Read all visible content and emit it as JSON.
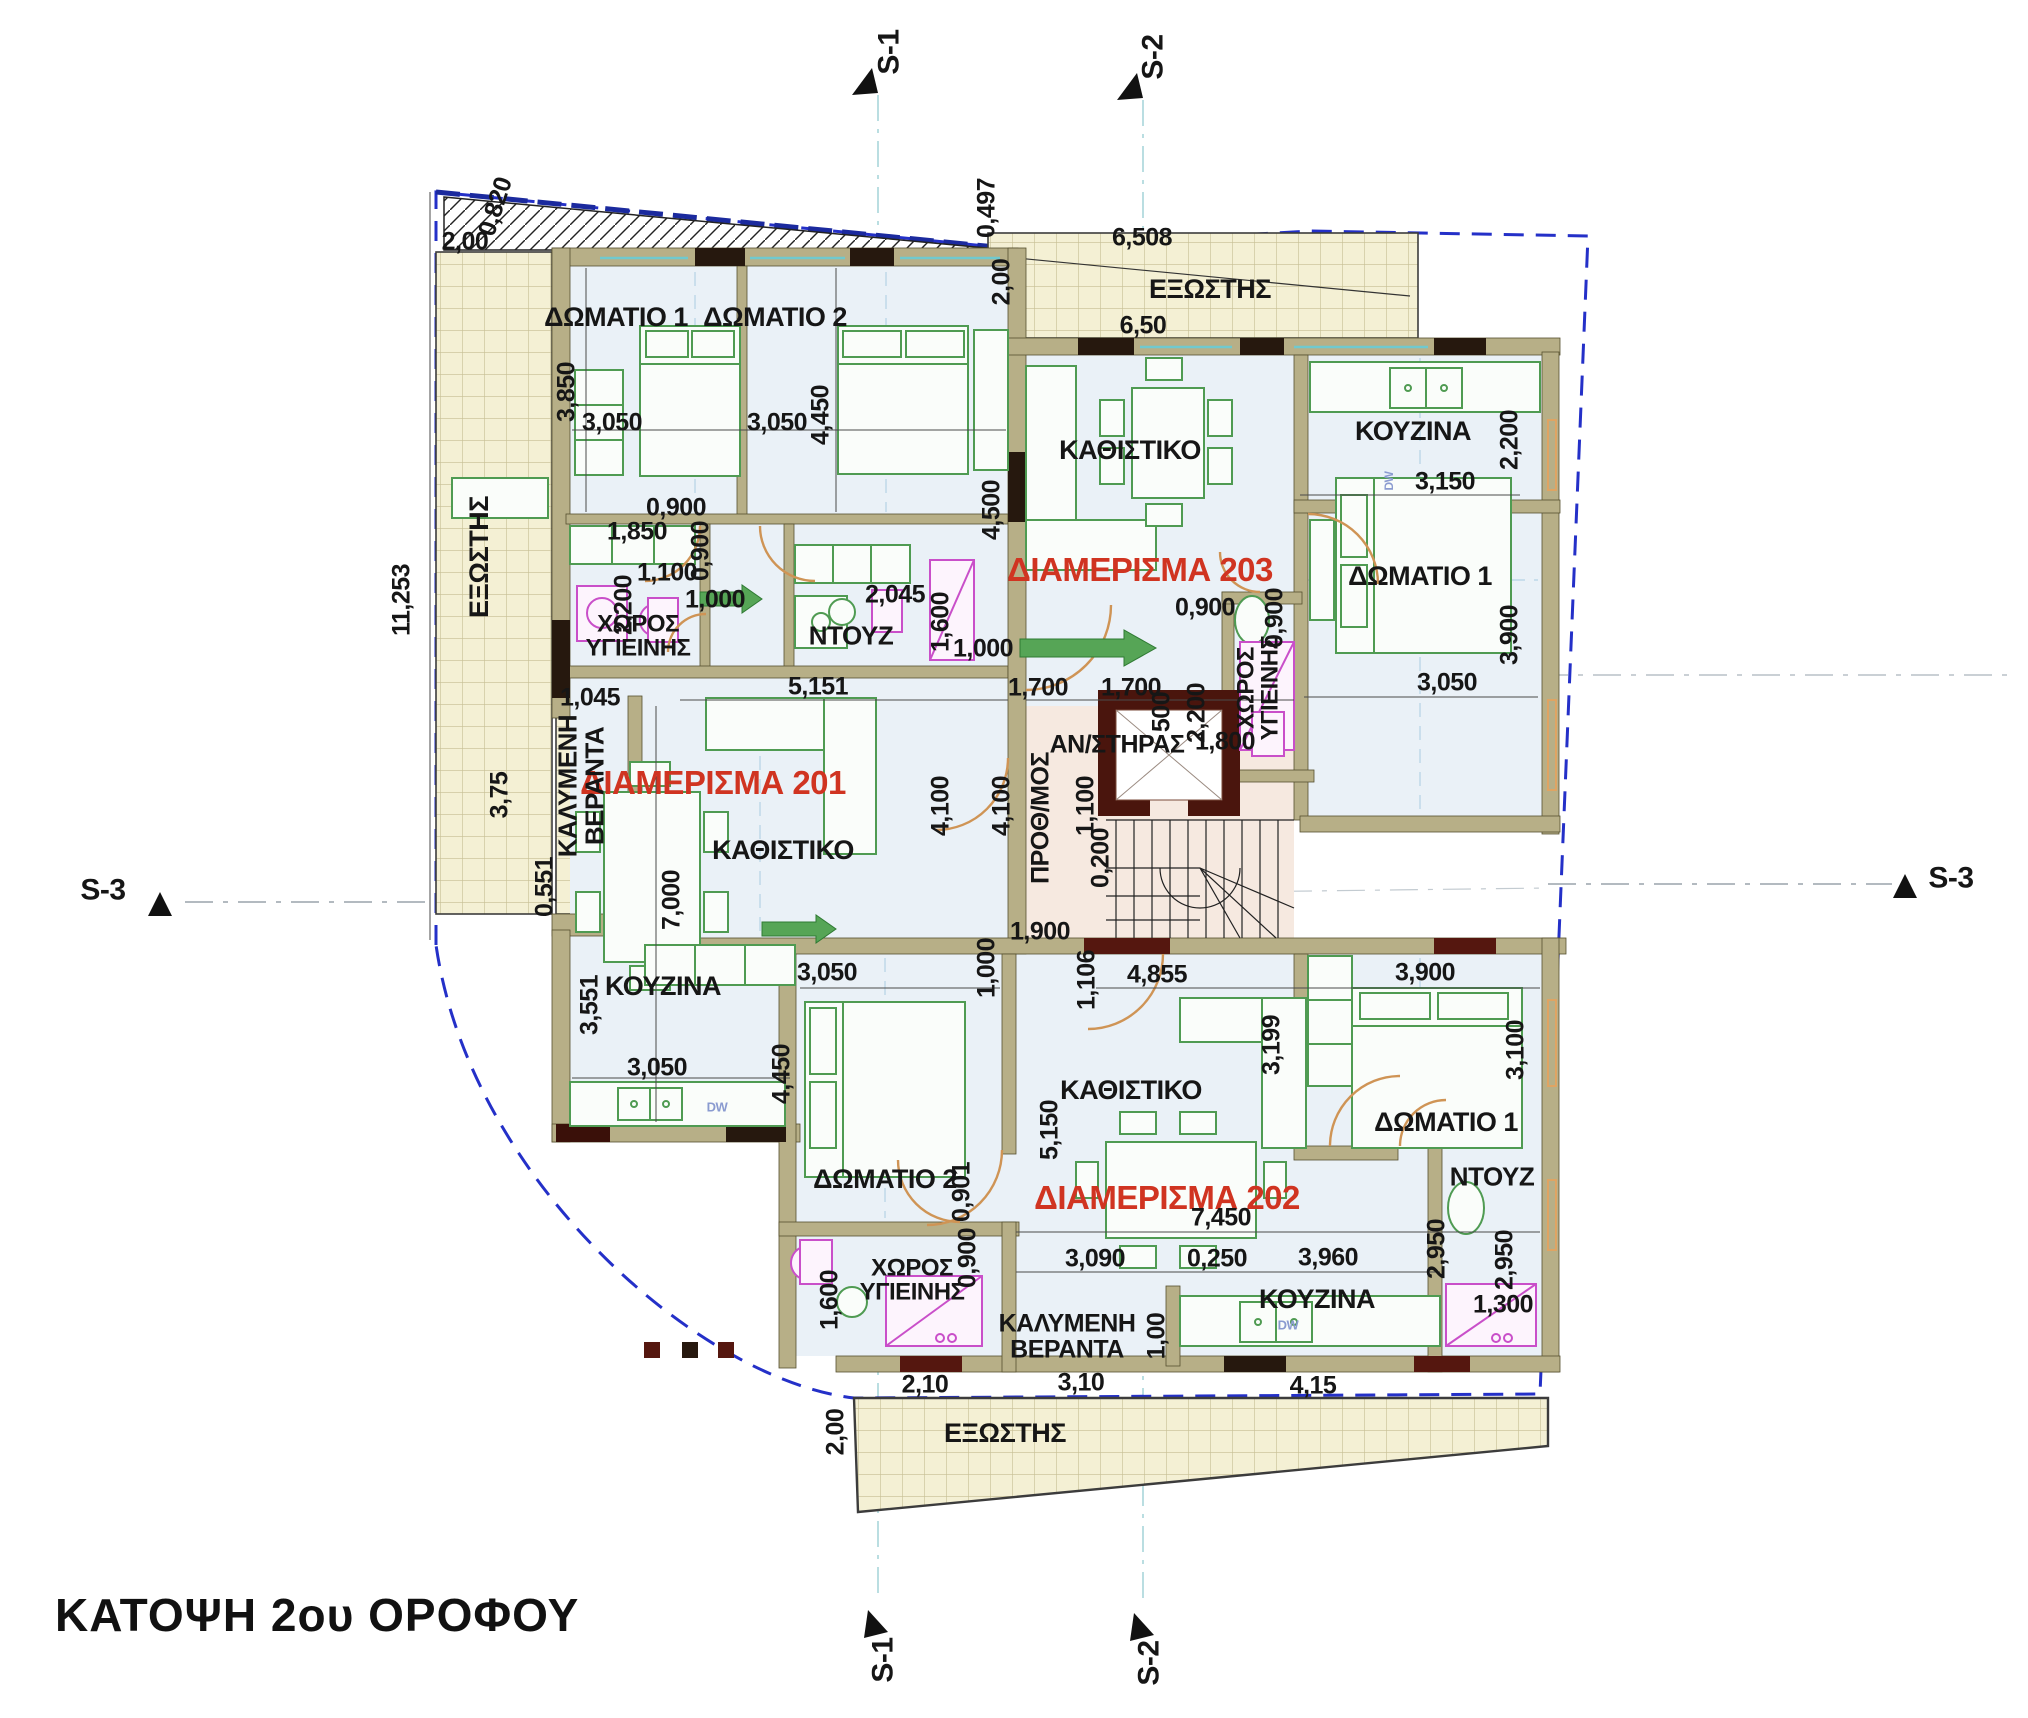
{
  "title": {
    "text": "ΚΑΤΟΨΗ 2ου ΟΡΟΦΟΥ"
  },
  "colors": {
    "apartment_label": "#d03421",
    "dimension_text": "#161616",
    "wall": "#b7af87",
    "room_floor": "#eaf1f7",
    "balcony_floor": "#f4f0d4",
    "stair_hall_floor": "#f6e9e0",
    "boundary_dashed": "#2430c8",
    "furniture_green": "#4f9b52",
    "fixture_magenta": "#c94fc9",
    "door_arc": "#cf9455"
  },
  "apartments": [
    "ΔΙΑΜΕΡΙΣΜΑ 201",
    "ΔΙΑΜΕΡΙΣΜΑ 202",
    "ΔΙΑΜΕΡΙΣΜΑ 203"
  ],
  "labels": [
    {
      "n": "section-marker-s1-top",
      "t": "S-1",
      "x": 890,
      "y": 52,
      "r": -90,
      "s": 30,
      "b": 1
    },
    {
      "n": "section-marker-s2-top",
      "t": "S-2",
      "x": 1154,
      "y": 57,
      "r": -90,
      "s": 30,
      "b": 1
    },
    {
      "n": "section-marker-s3-left",
      "t": "S-3",
      "x": 103,
      "y": 891,
      "r": 0,
      "s": 30,
      "b": 1
    },
    {
      "n": "section-marker-s3-right",
      "t": "S-3",
      "x": 1951,
      "y": 879,
      "r": 0,
      "s": 30,
      "b": 1
    },
    {
      "n": "section-marker-s1-bottom",
      "t": "S-1",
      "x": 884,
      "y": 1660,
      "r": -90,
      "s": 30,
      "b": 1
    },
    {
      "n": "section-marker-s2-bottom",
      "t": "S-2",
      "x": 1150,
      "y": 1663,
      "r": -90,
      "s": 30,
      "b": 1
    },
    {
      "n": "apartment-201-label",
      "t": "ΔΙΑΜΕΡΙΣΜΑ 201",
      "x": 713,
      "y": 783,
      "r": 0,
      "s": 33,
      "b": 1,
      "c": "#d03421"
    },
    {
      "n": "apartment-202-label",
      "t": "ΔΙΑΜΕΡΙΣΜΑ 202",
      "x": 1167,
      "y": 1198,
      "r": 0,
      "s": 33,
      "b": 1,
      "c": "#d03421"
    },
    {
      "n": "apartment-203-label",
      "t": "ΔΙΑΜΕΡΙΣΜΑ 203",
      "x": 1140,
      "y": 570,
      "r": 0,
      "s": 33,
      "b": 1,
      "c": "#d03421"
    },
    {
      "n": "room-201-bedroom1",
      "t": "ΔΩΜΑΤΙΟ 1",
      "x": 616,
      "y": 318,
      "r": 0,
      "s": 27,
      "b": 1
    },
    {
      "n": "room-201-bedroom2",
      "t": "ΔΩΜΑΤΙΟ 2",
      "x": 775,
      "y": 318,
      "r": 0,
      "s": 27,
      "b": 1
    },
    {
      "n": "room-201-bathroom",
      "t": "ΧΩΡΟΣ\nΥΓΙΕΙΝΗΣ",
      "x": 638,
      "y": 637,
      "r": 0,
      "s": 24,
      "b": 1
    },
    {
      "n": "room-201-shower",
      "t": "ΝΤΟΥΖ",
      "x": 851,
      "y": 636,
      "r": 0,
      "s": 26,
      "b": 1
    },
    {
      "n": "room-201-living",
      "t": "ΚΑΘΙΣΤΙΚΟ",
      "x": 783,
      "y": 851,
      "r": 0,
      "s": 27,
      "b": 1
    },
    {
      "n": "room-201-kitchen",
      "t": "ΚΟΥΖΙΝΑ",
      "x": 663,
      "y": 987,
      "r": 0,
      "s": 27,
      "b": 1
    },
    {
      "n": "room-201-covered-veranda",
      "t": "ΚΑΛΥΜΕΝΗ\nΒΕΡΑΝΤΑ",
      "x": 581,
      "y": 786,
      "r": -90,
      "s": 26,
      "b": 1
    },
    {
      "n": "room-balcony-left",
      "t": "ΕΞΩΣΤΗΣ",
      "x": 480,
      "y": 557,
      "r": -90,
      "s": 27,
      "b": 1
    },
    {
      "n": "room-balcony-top",
      "t": "ΕΞΩΣΤΗΣ",
      "x": 1210,
      "y": 290,
      "r": 0,
      "s": 27,
      "b": 1
    },
    {
      "n": "room-203-living",
      "t": "ΚΑΘΙΣΤΙΚΟ",
      "x": 1130,
      "y": 451,
      "r": 0,
      "s": 27,
      "b": 1
    },
    {
      "n": "room-203-kitchen",
      "t": "ΚΟΥΖΙΝΑ",
      "x": 1413,
      "y": 432,
      "r": 0,
      "s": 27,
      "b": 1
    },
    {
      "n": "room-203-bedroom1",
      "t": "ΔΩΜΑΤΙΟ 1",
      "x": 1420,
      "y": 577,
      "r": 0,
      "s": 27,
      "b": 1
    },
    {
      "n": "room-203-bathroom",
      "t": "ΧΩΡΟΣ\nΥΓΙΕΙΝΗΣ",
      "x": 1259,
      "y": 688,
      "r": -90,
      "s": 24,
      "b": 1
    },
    {
      "n": "room-elevator",
      "t": "ΑΝ/ΣΤΗΡΑΣ",
      "x": 1117,
      "y": 745,
      "r": 0,
      "s": 25,
      "b": 1
    },
    {
      "n": "room-entry-hall",
      "t": "ΠΡΟΘ/ΜΟΣ",
      "x": 1041,
      "y": 818,
      "r": -90,
      "s": 25,
      "b": 1
    },
    {
      "n": "room-202-living",
      "t": "ΚΑΘΙΣΤΙΚΟ",
      "x": 1131,
      "y": 1091,
      "r": 0,
      "s": 27,
      "b": 1
    },
    {
      "n": "room-202-bedroom2",
      "t": "ΔΩΜΑΤΙΟ 2",
      "x": 885,
      "y": 1180,
      "r": 0,
      "s": 27,
      "b": 1
    },
    {
      "n": "room-202-bedroom1",
      "t": "ΔΩΜΑΤΙΟ 1",
      "x": 1446,
      "y": 1123,
      "r": 0,
      "s": 27,
      "b": 1
    },
    {
      "n": "room-202-shower",
      "t": "ΝΤΟΥΖ",
      "x": 1492,
      "y": 1177,
      "r": 0,
      "s": 26,
      "b": 1
    },
    {
      "n": "room-202-kitchen",
      "t": "ΚΟΥΖΙΝΑ",
      "x": 1317,
      "y": 1300,
      "r": 0,
      "s": 27,
      "b": 1
    },
    {
      "n": "room-202-bathroom",
      "t": "ΧΩΡΟΣ\nΥΓΙΕΙΝΗΣ",
      "x": 912,
      "y": 1281,
      "r": 0,
      "s": 24,
      "b": 1
    },
    {
      "n": "room-202-covered-veranda",
      "t": "ΚΑΛΥΜΕΝΗ\nΒΕΡΑΝΤΑ",
      "x": 1067,
      "y": 1337,
      "r": 0,
      "s": 25,
      "b": 1
    },
    {
      "n": "room-balcony-bottom",
      "t": "ΕΞΩΣΤΗΣ",
      "x": 1005,
      "y": 1434,
      "r": 0,
      "s": 27,
      "b": 1
    },
    {
      "n": "dim",
      "t": "2,00",
      "x": 465,
      "y": 242,
      "r": 0,
      "s": 25
    },
    {
      "n": "dim",
      "t": "0,820",
      "x": 496,
      "y": 207,
      "r": -72,
      "s": 25
    },
    {
      "n": "dim",
      "t": "0,497",
      "x": 987,
      "y": 208,
      "r": -90,
      "s": 25
    },
    {
      "n": "dim",
      "t": "2,00",
      "x": 1002,
      "y": 282,
      "r": -90,
      "s": 25
    },
    {
      "n": "dim",
      "t": "6,508",
      "x": 1142,
      "y": 238,
      "r": 0,
      "s": 25
    },
    {
      "n": "dim",
      "t": "6,50",
      "x": 1143,
      "y": 326,
      "r": 0,
      "s": 25
    },
    {
      "n": "dim",
      "t": "3,850",
      "x": 567,
      "y": 392,
      "r": -90,
      "s": 25
    },
    {
      "n": "dim",
      "t": "3,050",
      "x": 612,
      "y": 423,
      "r": 0,
      "s": 25
    },
    {
      "n": "dim",
      "t": "3,050",
      "x": 777,
      "y": 423,
      "r": 0,
      "s": 25
    },
    {
      "n": "dim",
      "t": "4,450",
      "x": 821,
      "y": 415,
      "r": -90,
      "s": 25
    },
    {
      "n": "dim",
      "t": "0,900",
      "x": 676,
      "y": 508,
      "r": 0,
      "s": 25
    },
    {
      "n": "dim",
      "t": "0,900",
      "x": 701,
      "y": 551,
      "r": -90,
      "s": 25
    },
    {
      "n": "dim",
      "t": "1,850",
      "x": 637,
      "y": 532,
      "r": 0,
      "s": 25
    },
    {
      "n": "dim",
      "t": "2,200",
      "x": 624,
      "y": 605,
      "r": -90,
      "s": 25
    },
    {
      "n": "dim",
      "t": "1,100",
      "x": 667,
      "y": 573,
      "r": 0,
      "s": 25
    },
    {
      "n": "dim",
      "t": "1,000",
      "x": 715,
      "y": 600,
      "r": 0,
      "s": 25
    },
    {
      "n": "dim",
      "t": "2,045",
      "x": 895,
      "y": 595,
      "r": 0,
      "s": 25
    },
    {
      "n": "dim",
      "t": "1,600",
      "x": 941,
      "y": 622,
      "r": -90,
      "s": 25
    },
    {
      "n": "dim",
      "t": "1,000",
      "x": 983,
      "y": 649,
      "r": 0,
      "s": 25
    },
    {
      "n": "dim",
      "t": "5,151",
      "x": 818,
      "y": 687,
      "r": 0,
      "s": 25
    },
    {
      "n": "dim",
      "t": "11,253",
      "x": 402,
      "y": 600,
      "r": -90,
      "s": 25
    },
    {
      "n": "dim",
      "t": "3,75",
      "x": 500,
      "y": 795,
      "r": -90,
      "s": 25
    },
    {
      "n": "dim",
      "t": "0,551",
      "x": 545,
      "y": 887,
      "r": -90,
      "s": 25
    },
    {
      "n": "dim",
      "t": "1,045",
      "x": 590,
      "y": 698,
      "r": 0,
      "s": 25
    },
    {
      "n": "dim",
      "t": "7,000",
      "x": 672,
      "y": 900,
      "r": -90,
      "s": 25
    },
    {
      "n": "dim",
      "t": "3,551",
      "x": 590,
      "y": 1005,
      "r": -90,
      "s": 25
    },
    {
      "n": "dim",
      "t": "3,050",
      "x": 657,
      "y": 1068,
      "r": 0,
      "s": 25
    },
    {
      "n": "dim",
      "t": "4,100",
      "x": 941,
      "y": 806,
      "r": -90,
      "s": 25
    },
    {
      "n": "dim",
      "t": "4,100",
      "x": 1002,
      "y": 806,
      "r": -90,
      "s": 25
    },
    {
      "n": "dim",
      "t": "1,100",
      "x": 1086,
      "y": 806,
      "r": -90,
      "s": 25
    },
    {
      "n": "dim",
      "t": "0,200",
      "x": 1101,
      "y": 858,
      "r": -90,
      "s": 25
    },
    {
      "n": "dim",
      "t": "4,500",
      "x": 992,
      "y": 510,
      "r": -90,
      "s": 25
    },
    {
      "n": "dim",
      "t": "0,900",
      "x": 1205,
      "y": 608,
      "r": 0,
      "s": 25
    },
    {
      "n": "dim",
      "t": "1,700",
      "x": 1038,
      "y": 688,
      "r": 0,
      "s": 25
    },
    {
      "n": "dim",
      "t": "1,700",
      "x": 1131,
      "y": 688,
      "r": 0,
      "s": 25
    },
    {
      "n": "dim",
      "t": "500",
      "x": 1162,
      "y": 712,
      "r": -90,
      "s": 25
    },
    {
      "n": "dim",
      "t": "2,200",
      "x": 1197,
      "y": 713,
      "r": -90,
      "s": 25
    },
    {
      "n": "dim",
      "t": "1,800",
      "x": 1225,
      "y": 742,
      "r": 0,
      "s": 25
    },
    {
      "n": "dim",
      "t": "0,900",
      "x": 1275,
      "y": 618,
      "r": -90,
      "s": 25
    },
    {
      "n": "dim",
      "t": "3,150",
      "x": 1445,
      "y": 482,
      "r": 0,
      "s": 25
    },
    {
      "n": "dim",
      "t": "2,200",
      "x": 1510,
      "y": 440,
      "r": -90,
      "s": 25
    },
    {
      "n": "dim",
      "t": "3,050",
      "x": 1447,
      "y": 683,
      "r": 0,
      "s": 25
    },
    {
      "n": "dim",
      "t": "3,900",
      "x": 1510,
      "y": 635,
      "r": -90,
      "s": 25
    },
    {
      "n": "dim",
      "t": "1,900",
      "x": 1040,
      "y": 932,
      "r": 0,
      "s": 25
    },
    {
      "n": "dim",
      "t": "1,000",
      "x": 987,
      "y": 968,
      "r": -90,
      "s": 25
    },
    {
      "n": "dim",
      "t": "1,106",
      "x": 1087,
      "y": 980,
      "r": -90,
      "s": 25
    },
    {
      "n": "dim",
      "t": "4,855",
      "x": 1157,
      "y": 975,
      "r": 0,
      "s": 25
    },
    {
      "n": "dim",
      "t": "3,050",
      "x": 827,
      "y": 973,
      "r": 0,
      "s": 25
    },
    {
      "n": "dim",
      "t": "4,450",
      "x": 782,
      "y": 1074,
      "r": -90,
      "s": 25
    },
    {
      "n": "dim",
      "t": "0,901",
      "x": 962,
      "y": 1192,
      "r": -90,
      "s": 25
    },
    {
      "n": "dim",
      "t": "0,900",
      "x": 968,
      "y": 1258,
      "r": -90,
      "s": 25
    },
    {
      "n": "dim",
      "t": "5,150",
      "x": 1050,
      "y": 1130,
      "r": -90,
      "s": 25
    },
    {
      "n": "dim",
      "t": "3,199",
      "x": 1272,
      "y": 1045,
      "r": -90,
      "s": 25
    },
    {
      "n": "dim",
      "t": "3,900",
      "x": 1425,
      "y": 973,
      "r": 0,
      "s": 25
    },
    {
      "n": "dim",
      "t": "3,100",
      "x": 1516,
      "y": 1050,
      "r": -90,
      "s": 25
    },
    {
      "n": "dim",
      "t": "7,450",
      "x": 1221,
      "y": 1218,
      "r": 0,
      "s": 25
    },
    {
      "n": "dim",
      "t": "3,090",
      "x": 1095,
      "y": 1259,
      "r": 0,
      "s": 25
    },
    {
      "n": "dim",
      "t": "0,250",
      "x": 1217,
      "y": 1259,
      "r": 0,
      "s": 25
    },
    {
      "n": "dim",
      "t": "3,960",
      "x": 1328,
      "y": 1258,
      "r": 0,
      "s": 25
    },
    {
      "n": "dim",
      "t": "2,950",
      "x": 1437,
      "y": 1249,
      "r": -90,
      "s": 25
    },
    {
      "n": "dim",
      "t": "2,950",
      "x": 1505,
      "y": 1260,
      "r": -90,
      "s": 25
    },
    {
      "n": "dim",
      "t": "1,300",
      "x": 1503,
      "y": 1305,
      "r": 0,
      "s": 25
    },
    {
      "n": "dim",
      "t": "1,600",
      "x": 830,
      "y": 1300,
      "r": -90,
      "s": 25
    },
    {
      "n": "dim",
      "t": "2,10",
      "x": 925,
      "y": 1385,
      "r": 0,
      "s": 25
    },
    {
      "n": "dim",
      "t": "3,10",
      "x": 1081,
      "y": 1383,
      "r": 0,
      "s": 25
    },
    {
      "n": "dim",
      "t": "4,15",
      "x": 1313,
      "y": 1386,
      "r": 0,
      "s": 25
    },
    {
      "n": "dim",
      "t": "1,00",
      "x": 1157,
      "y": 1336,
      "r": -90,
      "s": 25
    },
    {
      "n": "dim",
      "t": "2,00",
      "x": 836,
      "y": 1432,
      "r": -90,
      "s": 25
    },
    {
      "n": "appliance-dw-201",
      "t": "DW",
      "x": 717,
      "y": 1107,
      "r": 0,
      "s": 13,
      "c": "#8a9bd0"
    },
    {
      "n": "appliance-dw-202",
      "t": "DW",
      "x": 1288,
      "y": 1325,
      "r": 0,
      "s": 13,
      "c": "#8a9bd0"
    },
    {
      "n": "appliance-dw-203",
      "t": "DW",
      "x": 1389,
      "y": 481,
      "r": -90,
      "s": 12,
      "c": "#8a9bd0"
    }
  ]
}
